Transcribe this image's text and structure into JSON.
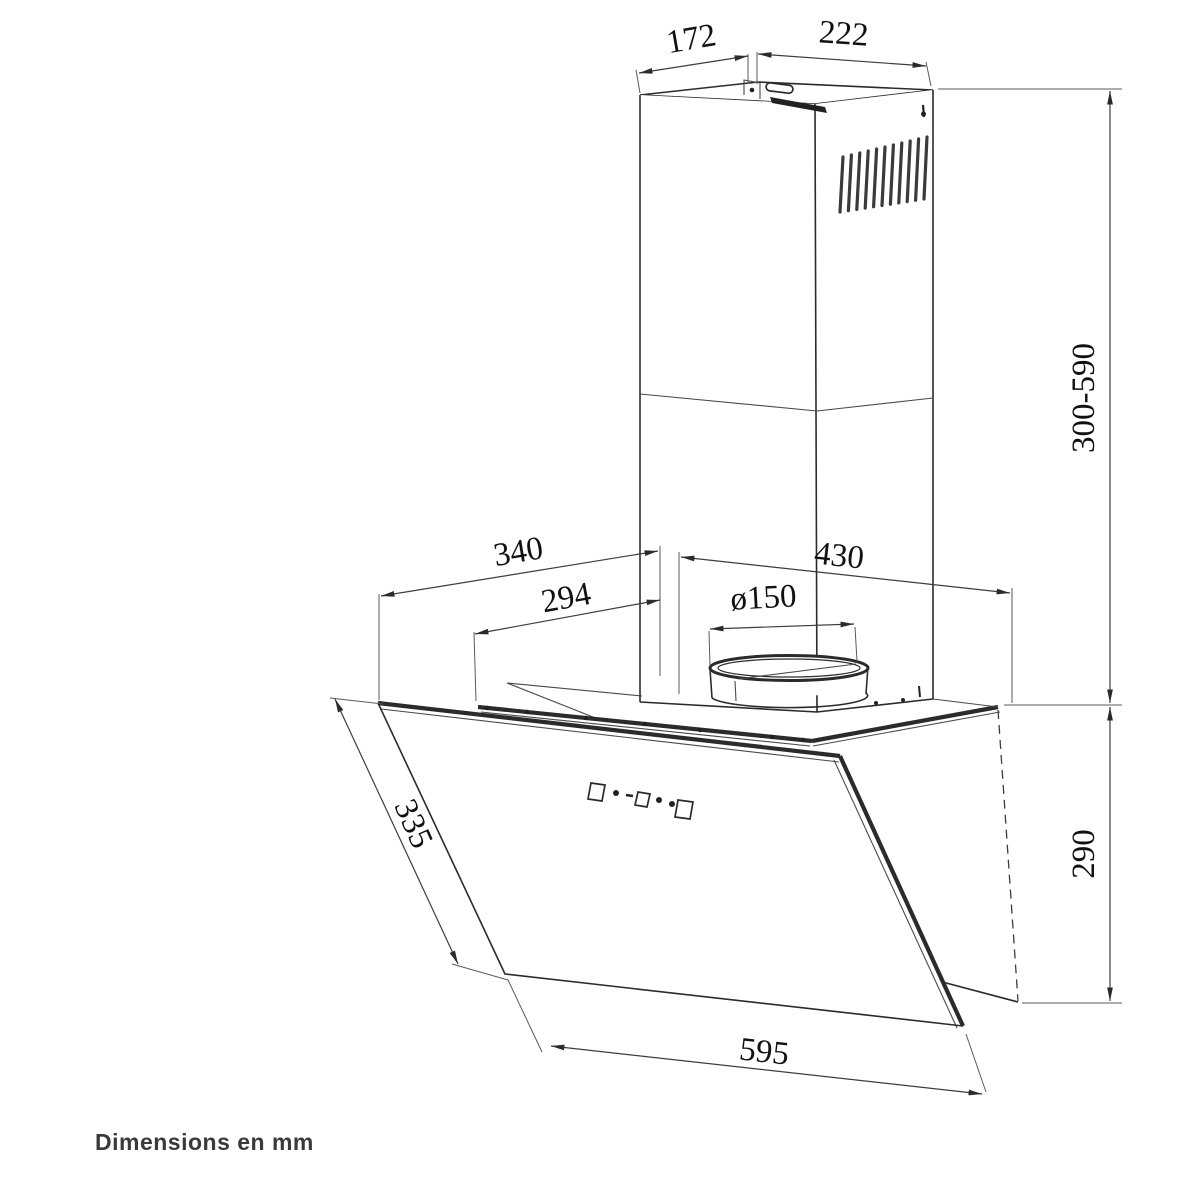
{
  "figure": {
    "subject": "wall-mounted-angled-cooker-hood-dimension-drawing",
    "units_note": "Dimensions en mm",
    "labels": {
      "chimney_top_depth": "172",
      "chimney_top_width": "222",
      "chimney_height_range": "300-590",
      "hood_top_depth": "340",
      "hood_top_inner_depth": "294",
      "duct_diameter": "ø150",
      "hood_top_width": "430",
      "glass_side_length": "335",
      "body_height": "290",
      "glass_width": "595"
    }
  }
}
